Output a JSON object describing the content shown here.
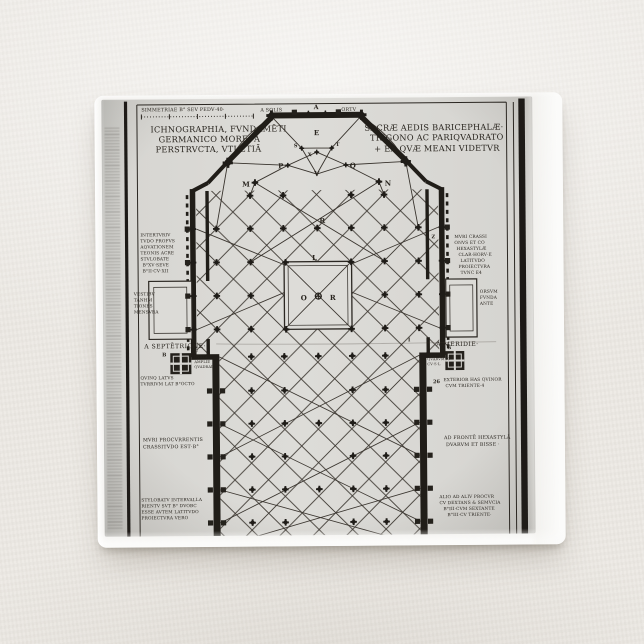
{
  "colors": {
    "backdrop": "#ece9e4",
    "button_face": "#f2f1ee",
    "paper": "#dddcd8",
    "ink": "#221f1a"
  },
  "engraving": {
    "scale_label": "SIMMETRIAE B° SEV PEDV·40·",
    "direction_left": "A SOLIS",
    "direction_right": "ORTV",
    "compass_left": "A SEPTĒTRIONE·",
    "compass_right": "A MERIDIE·",
    "title_left": [
      "ICHNOGRAPHIA, FVNDAMĒTI",
      "GERMANICO MORE. A",
      "PERSTRVCTA, VTI ETIĀ"
    ],
    "title_right": [
      "SACRÆ AEDIS BARICEPHALÆ·",
      "TRIGONO AC PARIQVADRATO",
      "+ EA QVÆ MEANI VIDETVR"
    ],
    "letters": {
      "apex": "A",
      "e": "E",
      "s": "S",
      "t": "T",
      "x": "X",
      "p": "P",
      "q": "Q",
      "v": "V",
      "m": "M",
      "n": "N",
      "r_upper": "R",
      "l": "L",
      "o": "O",
      "r_center": "R",
      "z": "Z",
      "i": "I",
      "g": "G",
      "n26": "26",
      "b": "B",
      "f": "F"
    },
    "notes": {
      "left_upper": [
        "INTERTVRIV",
        "TVDO PROFVS",
        "AQVATIONEM",
        "TEONIS ACRE",
        "STVLOBATE",
        "B°XV·SEVE",
        "B°II·CV·XII"
      ],
      "left_mid": [
        "VESTIBV",
        "TANHM",
        "TIONES",
        "MENSVRA"
      ],
      "right_upper": [
        "MVRI CRASSI",
        "ONVS ET CO",
        "HEXASTYLÆ",
        "CLAR·HORV·E",
        "LATITVDO",
        "PROIECTVRA",
        "TVNC E4"
      ],
      "right_mid": [
        "ORSVM",
        "FVNDA",
        "ANTE"
      ],
      "left_tower_small": [
        "DVXTA",
        "AMPLIE",
        "QVADRAE"
      ],
      "left_tower": [
        "QVINQ LATVS",
        "TVRRIVM LAT B°OCTO"
      ],
      "right_tower_small": [
        "QVARVM IC",
        "CV·S·L"
      ],
      "right_tower": [
        "EXTERIOR HAS QVINOR",
        "CVM TRIENTE·4"
      ],
      "left_lower": [
        "MVRI PROCVRRENTIS",
        "CRASSITVDO EST·B°"
      ],
      "right_lower": [
        "AD FRONTĒ HEXASTYLĀ",
        "DVARVM ET BISSE ·"
      ],
      "left_bottom": [
        "STYLOBATV INTERVALLA",
        "RIENTV SVT B° DVOBC",
        "ESSE AVTEM LATITVDO",
        "PROIECTVRA VERO"
      ],
      "right_bottom": [
        "ALIO AD ALIV PROCVR",
        "CV DEXTANS & SEMVCIA",
        "B°III·CVM SEXTANTE",
        "B°III·CV TRIENTE·"
      ]
    }
  }
}
